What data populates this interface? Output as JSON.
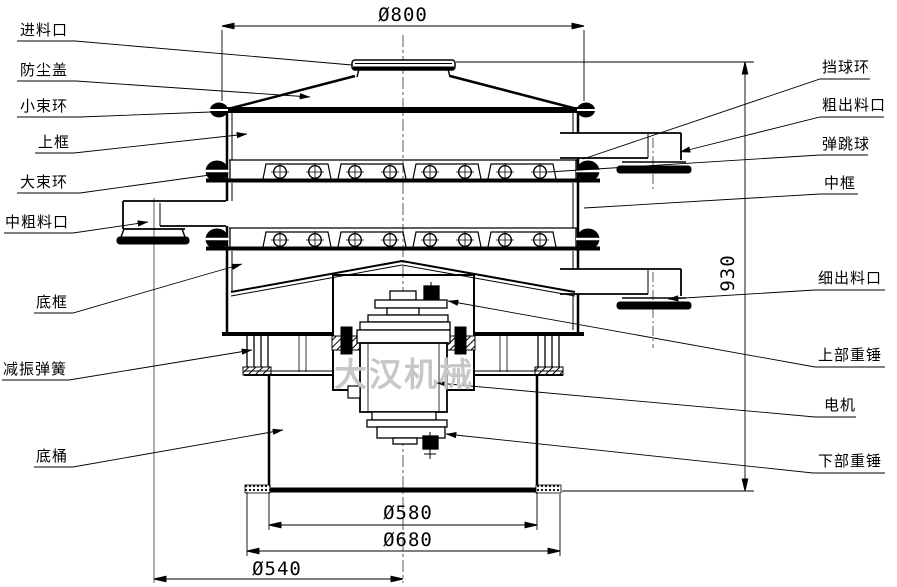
{
  "diagram": {
    "watermark": "大汉机械",
    "labels_left": [
      {
        "id": "feed-inlet",
        "text": "进料口"
      },
      {
        "id": "dust-cover",
        "text": "防尘盖"
      },
      {
        "id": "small-clamp-ring",
        "text": "小束环"
      },
      {
        "id": "upper-frame",
        "text": "上框"
      },
      {
        "id": "large-clamp-ring",
        "text": "大束环"
      },
      {
        "id": "medium-coarse-outlet",
        "text": "中粗料口"
      },
      {
        "id": "bottom-frame",
        "text": "底框"
      },
      {
        "id": "damping-spring",
        "text": "减振弹簧"
      },
      {
        "id": "base-barrel",
        "text": "底桶"
      }
    ],
    "labels_right": [
      {
        "id": "ball-stop-ring",
        "text": "挡球环"
      },
      {
        "id": "coarse-outlet",
        "text": "粗出料口"
      },
      {
        "id": "bouncing-ball",
        "text": "弹跳球"
      },
      {
        "id": "middle-frame",
        "text": "中框"
      },
      {
        "id": "fine-outlet",
        "text": "细出料口"
      },
      {
        "id": "upper-weight",
        "text": "上部重锤"
      },
      {
        "id": "motor",
        "text": "电机"
      },
      {
        "id": "lower-weight",
        "text": "下部重锤"
      }
    ],
    "dimensions": {
      "top_diameter": "Ø800",
      "overall_height": "930",
      "barrel_diameter": "Ø580",
      "base_flange_diameter": "Ø680",
      "outlet_circle_diameter": "Ø540"
    },
    "line_color": "#000000",
    "watermark_color": "#c7c7c7"
  }
}
